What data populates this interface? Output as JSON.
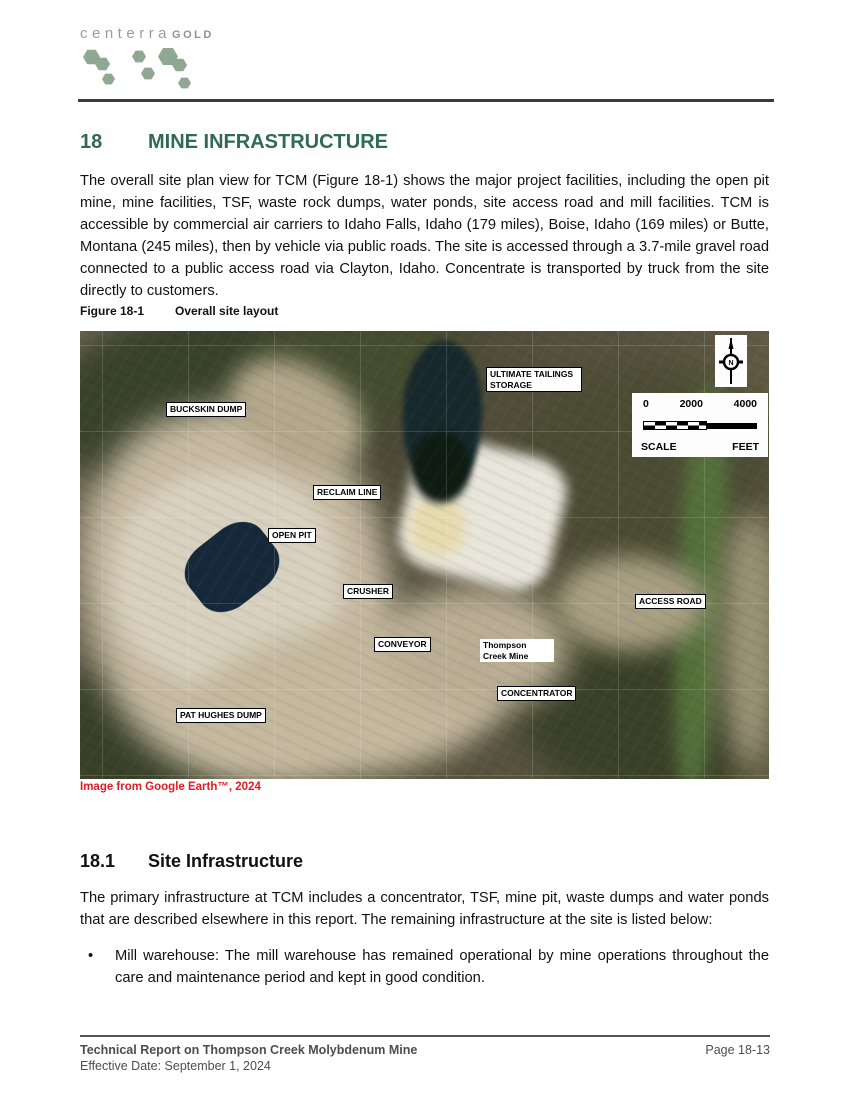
{
  "logo": {
    "brand": "centerra",
    "brand_suffix": "GOLD"
  },
  "section": {
    "number": "18",
    "title": "MINE INFRASTRUCTURE"
  },
  "paragraph1": "The overall site plan view for TCM (Figure 18-1) shows the major project facilities, including the open pit mine, mine facilities, TSF, waste rock dumps, water ponds, site access road and mill facilities. TCM is accessible by commercial air carriers to Idaho Falls, Idaho (179 miles), Boise, Idaho (169 miles) or Butte, Montana (245 miles), then by vehicle via public roads. The site is accessed through a 3.7-mile gravel road connected to a public access road via Clayton, Idaho. Concentrate is transported by truck from the site directly to customers.",
  "figure": {
    "label": "Figure 18-1",
    "title": "Overall site layout",
    "credit": "Image from Google Earth™, 2024",
    "north_label": "N",
    "scale": {
      "ticks": [
        "0",
        "2000",
        "4000"
      ],
      "scale_label": "SCALE",
      "unit_label": "FEET"
    },
    "map_labels": [
      {
        "text": "BUCKSKIN DUMP",
        "x": 86,
        "y": 71
      },
      {
        "text": "ULTIMATE TAILINGS STORAGE",
        "x": 406,
        "y": 36,
        "w": 88,
        "wrap": true
      },
      {
        "text": "RECLAIM LINE",
        "x": 233,
        "y": 154
      },
      {
        "text": "OPEN PIT",
        "x": 188,
        "y": 197
      },
      {
        "text": "CRUSHER",
        "x": 263,
        "y": 253
      },
      {
        "text": "ACCESS ROAD",
        "x": 555,
        "y": 263
      },
      {
        "text": "CONVEYOR",
        "x": 294,
        "y": 306
      },
      {
        "text": "Thompson Creek Mine",
        "x": 400,
        "y": 308,
        "w": 68,
        "plain": true
      },
      {
        "text": "CONCENTRATOR",
        "x": 417,
        "y": 355
      },
      {
        "text": "PAT HUGHES DUMP",
        "x": 96,
        "y": 377
      }
    ]
  },
  "subsection": {
    "number": "18.1",
    "title": "Site Infrastructure"
  },
  "paragraph2": "The primary infrastructure at TCM includes a concentrator, TSF, mine pit, waste dumps and water ponds that are described elsewhere in this report. The remaining infrastructure at the site is listed below:",
  "bullets": [
    {
      "marker": "•",
      "text": "Mill warehouse: The mill warehouse has remained operational by mine operations throughout the care and maintenance period and kept in good condition."
    }
  ],
  "footer": {
    "line1": "Technical Report on Thompson Creek Molybdenum Mine",
    "line2": "Effective Date: September 1, 2024",
    "page": "Page 18-13"
  },
  "colors": {
    "heading_green": "#2f6a54",
    "credit_red": "#e31b23",
    "logo_hex_green": "#8fa793",
    "footer_gray": "#4d4d4d"
  }
}
